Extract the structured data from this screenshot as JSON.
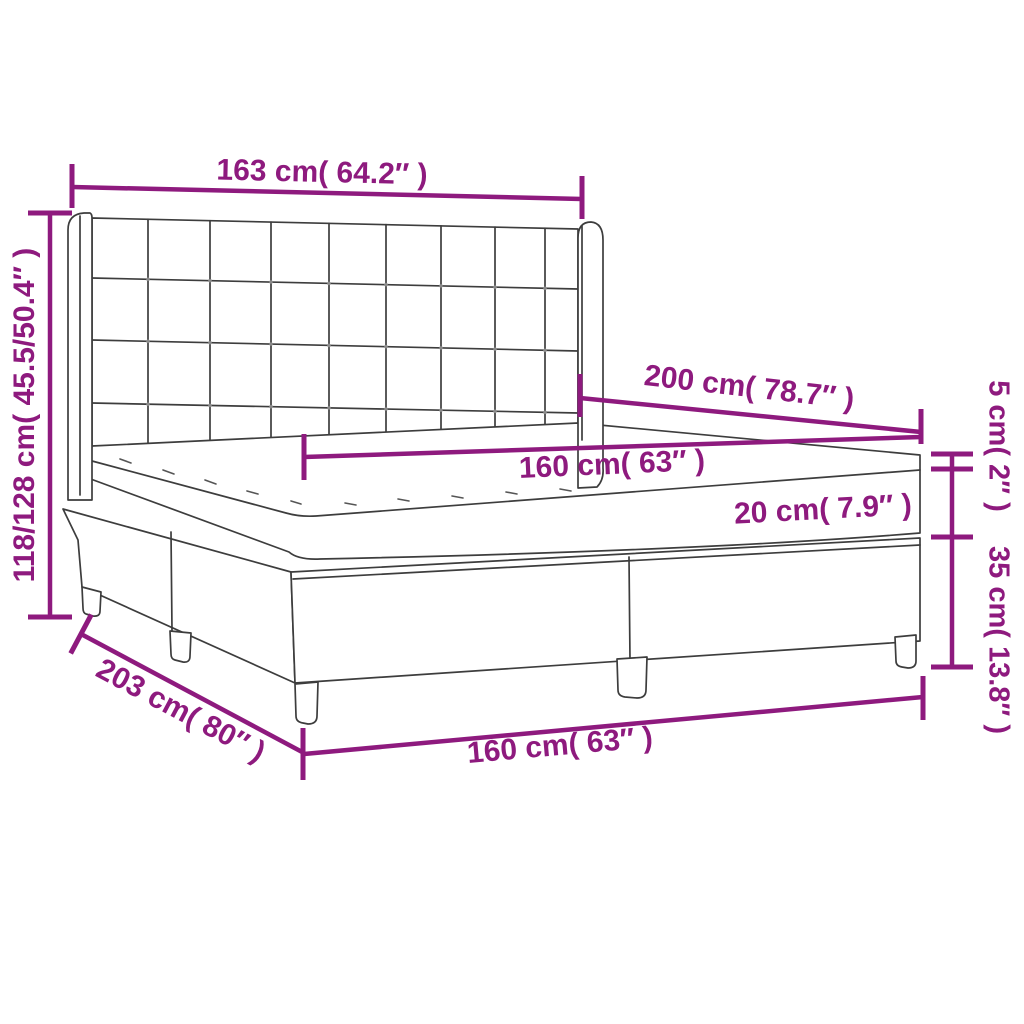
{
  "diagram": {
    "title": "box-spring-bed-dimension-diagram",
    "colors": {
      "dimension_magenta": "#8E1A7E",
      "bed_outline_gray": "#3D3D3D",
      "background": "#FFFFFF"
    },
    "labels": {
      "headboard_width": "163 cm( 64.2″ )",
      "overall_height": "118/128 cm( 45.5/50.4″ )",
      "bed_length": "200 cm( 78.7″ )",
      "mattress_width": "160 cm( 63″ )",
      "mattress_height": "20 cm( 7.9″ )",
      "topper_height": "5 cm( 2″ )",
      "base_height": "35 cm( 13.8″ )",
      "base_length": "203 cm( 80″ )",
      "base_width": "160 cm( 63″ )"
    }
  }
}
